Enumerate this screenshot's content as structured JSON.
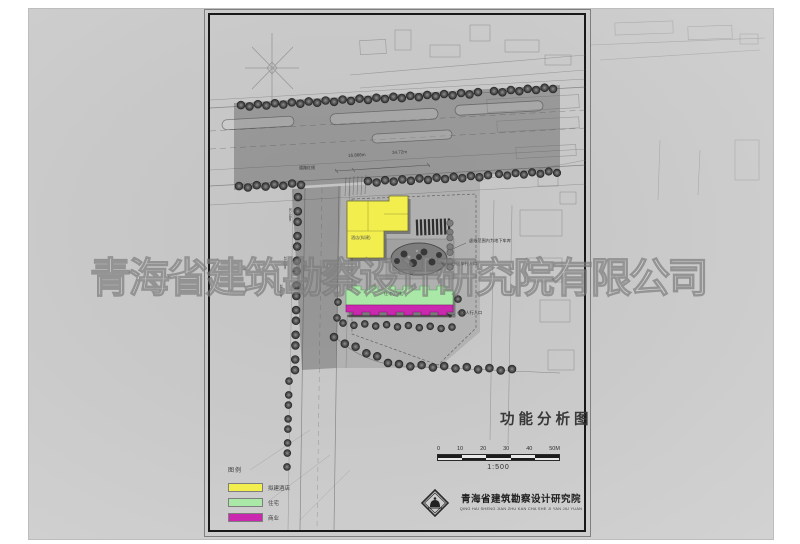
{
  "titles": {
    "drawing_title": "功能分析图",
    "scale_ratio": "1:500"
  },
  "scale_bar": {
    "ticks": [
      "0",
      "10",
      "20",
      "30",
      "40",
      "50M"
    ]
  },
  "legend": {
    "title": "图例",
    "items": [
      {
        "label": "拟建酒店",
        "color": "#f2ee4e"
      },
      {
        "label": "住宅",
        "color": "#a9e8a6"
      },
      {
        "label": "商业",
        "color": "#ca28ae"
      }
    ]
  },
  "buildings": {
    "hotel_label": "酒店(拟建)",
    "residence_label": "住宅(已建)"
  },
  "colors": {
    "hotel": "#f2ee4e",
    "residential": "#a9e8a6",
    "commercial": "#ca28ae"
  },
  "watermark": {
    "text": "青海省建筑勘察设计研究院有限公司"
  },
  "institute": {
    "name": "青海省建筑勘察设计研究院",
    "pinyin": "QING HAI SHENG JIAN ZHU KAN CHA SHE JI YAN JIU YUAN"
  },
  "annotations": [
    {
      "text": "道路红线",
      "x": 299,
      "y": 166,
      "s": 4,
      "rot": 0,
      "c": "#2e2e2e"
    },
    {
      "text": "16.866m",
      "x": 348,
      "y": 154,
      "s": 4.5,
      "rot": -3,
      "c": "#3a3a3a"
    },
    {
      "text": "34.72m",
      "x": 392,
      "y": 151,
      "s": 4.5,
      "rot": -3,
      "c": "#3a3a3a"
    },
    {
      "text": "50.98m",
      "x": 292,
      "y": 208,
      "s": 4,
      "rot": 90,
      "c": "#3a3a3a"
    },
    {
      "text": "15.00m",
      "x": 287,
      "y": 256,
      "s": 4,
      "rot": 90,
      "c": "#3a3a3a"
    },
    {
      "text": "16.00m",
      "x": 283,
      "y": 284,
      "s": 4,
      "rot": 90,
      "c": "#3a3a3a"
    },
    {
      "text": "虚线范围内为地下车库",
      "x": 469,
      "y": 239,
      "s": 4.2,
      "rot": 0,
      "c": "#2f2f2f"
    },
    {
      "text": "小区车行入口",
      "x": 452,
      "y": 262,
      "s": 4.2,
      "rot": 0,
      "c": "#2f2f2f"
    },
    {
      "text": "小区人行入口",
      "x": 457,
      "y": 311,
      "s": 4.2,
      "rot": 0,
      "c": "#2f2f2f"
    }
  ],
  "trees": {
    "rows": [
      {
        "x0": 241,
        "y0": 106,
        "x1": 478,
        "y1": 93,
        "n": 29,
        "r": 4
      },
      {
        "x0": 494,
        "y0": 92,
        "x1": 553,
        "y1": 88,
        "n": 8,
        "r": 4
      },
      {
        "x0": 239,
        "y0": 187,
        "x1": 301,
        "y1": 184,
        "n": 8,
        "r": 4
      },
      {
        "x0": 368,
        "y0": 182,
        "x1": 488,
        "y1": 176,
        "n": 15,
        "r": 4
      },
      {
        "x0": 499,
        "y0": 175,
        "x1": 557,
        "y1": 172,
        "n": 8,
        "r": 3.8
      },
      {
        "x0": 298,
        "y0": 198,
        "x1": 295,
        "y1": 371,
        "n": 15,
        "r": 4
      },
      {
        "x0": 334,
        "y0": 338,
        "x1": 388,
        "y1": 362,
        "n": 6,
        "r": 4
      },
      {
        "x0": 399,
        "y0": 365,
        "x1": 512,
        "y1": 370,
        "n": 11,
        "r": 4
      },
      {
        "x0": 343,
        "y0": 324,
        "x1": 452,
        "y1": 328,
        "n": 11,
        "r": 3.5
      },
      {
        "x0": 289,
        "y0": 382,
        "x1": 287,
        "y1": 466,
        "n": 8,
        "r": 3.5
      },
      {
        "x0": 450,
        "y0": 224,
        "x1": 450,
        "y1": 268,
        "n": 7,
        "r": 3.2,
        "light": true
      },
      {
        "x0": 338,
        "y0": 303,
        "x1": 337,
        "y1": 317,
        "n": 2,
        "r": 3.5
      },
      {
        "x0": 458,
        "y0": 300,
        "x1": 462,
        "y1": 312,
        "n": 2,
        "r": 3.5
      }
    ]
  }
}
